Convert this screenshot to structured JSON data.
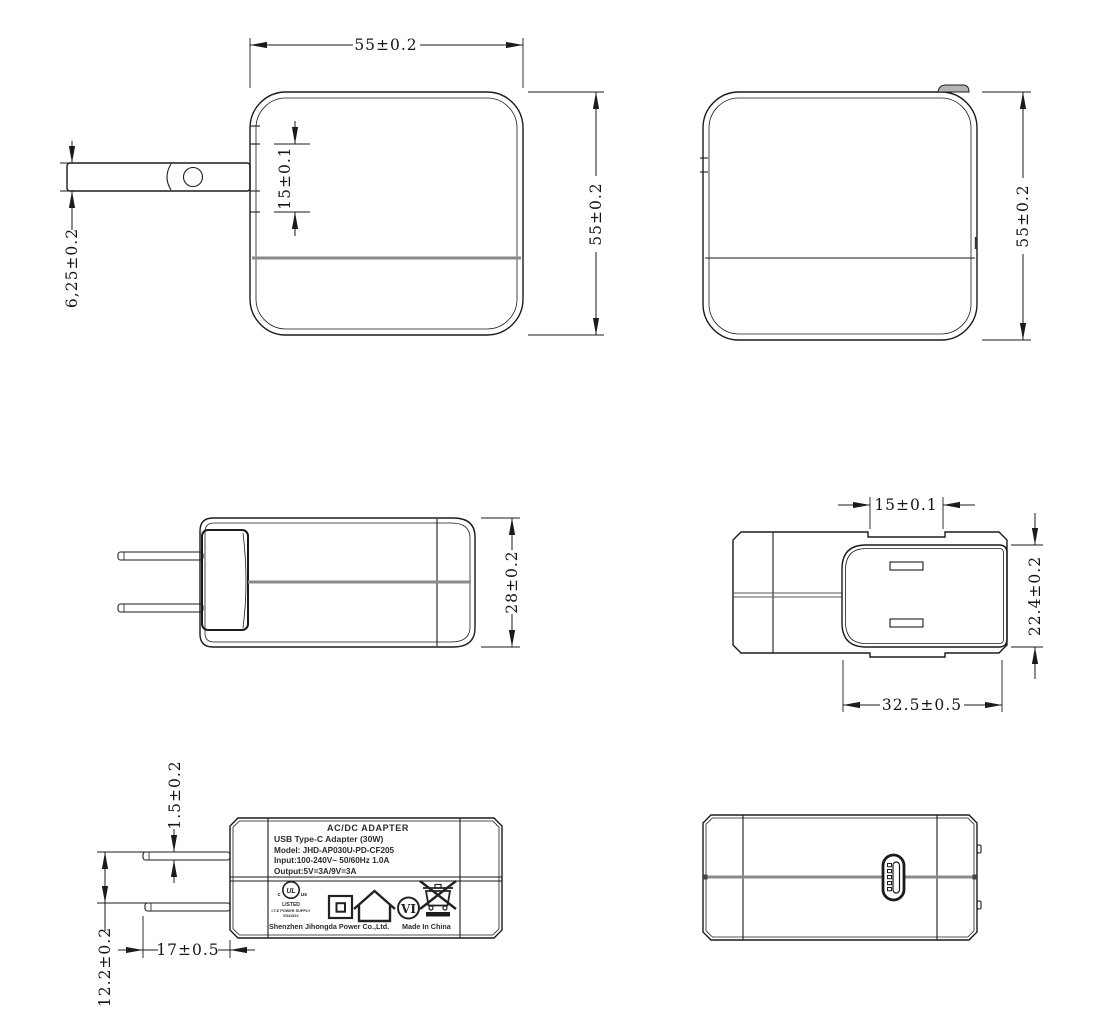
{
  "drawing": {
    "title": "AC/DC adapter mechanical drawing, six orthographic views",
    "colors": {
      "line": "#1b1b1b",
      "seam_gray": "#8a8a8a",
      "background": "#ffffff"
    }
  },
  "views": {
    "front": {
      "dims": {
        "width_top": "55±0.2",
        "height_right": "55±0.2",
        "recess_height": "15±0.1",
        "blade_width": "6,25±0.2"
      }
    },
    "rear": {
      "dims": {
        "height_right": "55±0.2"
      }
    },
    "top": {
      "dims": {
        "depth": "28±0.2"
      }
    },
    "bottom": {
      "dims": {
        "recess_width": "15±0.1",
        "base_height": "22.4±0.2",
        "base_width": "32.5±0.5"
      }
    },
    "label_face": {
      "dims": {
        "blade_thickness": "1.5±0.2",
        "blade_spacing": "12.2±0.2",
        "blade_length": "17±0.5"
      },
      "label": {
        "title": "AC/DC  ADAPTER",
        "subtitle": "USB Type-C Adapter   (30W)",
        "model": "Model: JHD-AP030U-PD-CF205",
        "input": "Input:100-240V~  50/60Hz  1.0A",
        "output": "Output:5V=3A/9V=3A",
        "ul": {
          "c": "c",
          "us": "us",
          "mark": "UL",
          "listed": "LISTED",
          "type": "I.T.E POWER SUPPLY",
          "file": "E341922"
        },
        "efficiency_mark": "VI",
        "manufacturer": "Shenzhen Jihongda Power Co.,Ltd.",
        "origin": "Made In China"
      }
    },
    "output_face": {}
  }
}
